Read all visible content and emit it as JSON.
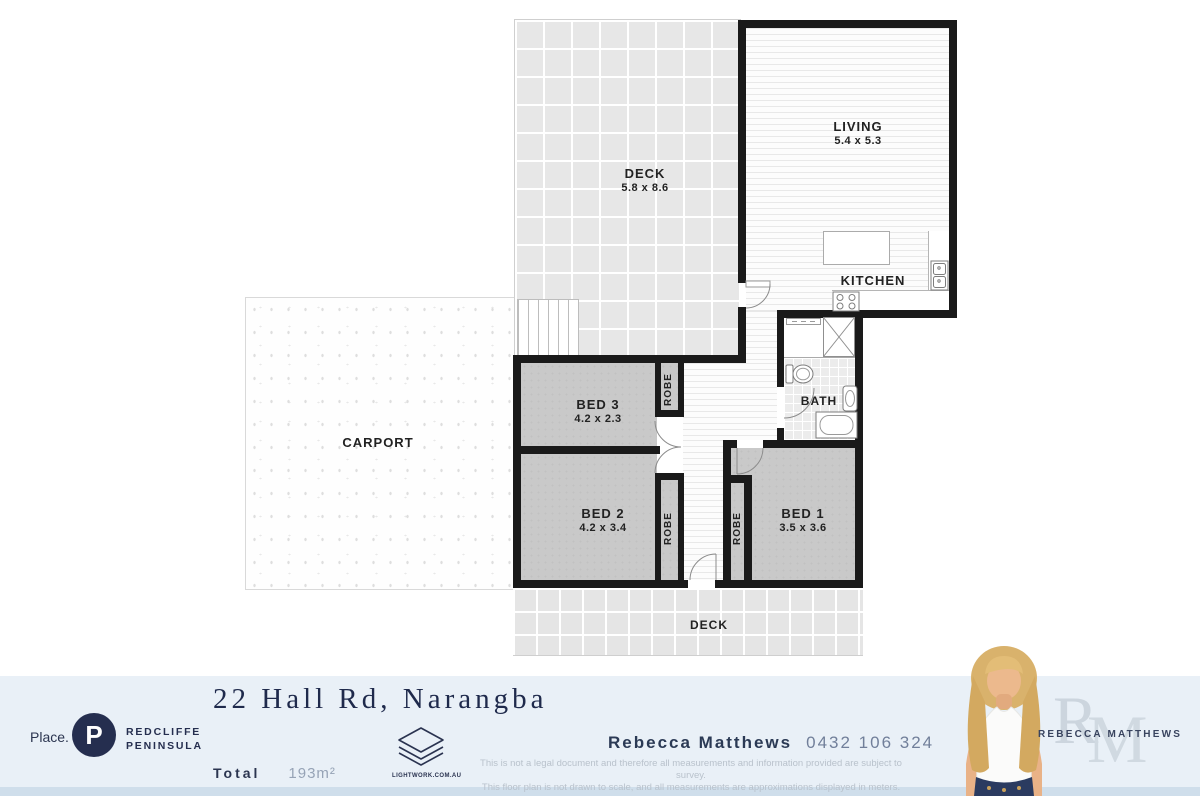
{
  "plan": {
    "rooms": {
      "deck_top": {
        "label": "DECK",
        "dims": "5.8 x 8.6"
      },
      "living": {
        "label": "LIVING",
        "dims": "5.4 x 5.3"
      },
      "kitchen": {
        "label": "KITCHEN"
      },
      "carport": {
        "label": "CARPORT"
      },
      "bed3": {
        "label": "BED 3",
        "dims": "4.2 x 2.3"
      },
      "bed2": {
        "label": "BED 2",
        "dims": "4.2 x 3.4"
      },
      "bed1": {
        "label": "BED 1",
        "dims": "3.5 x 3.6"
      },
      "bath": {
        "label": "BATH"
      },
      "deck_bottom": {
        "label": "DECK"
      },
      "robe": "ROBE"
    }
  },
  "footer": {
    "place_label": "Place.",
    "place_logo_letter": "P",
    "brand_line1": "REDCLIFFE",
    "brand_line2": "PENINSULA",
    "title": "22 Hall Rd, Narangba",
    "total_label": "Total",
    "total_value": "193m²",
    "lightwork_label": "LIGHTWORK.COM.AU",
    "agent_name": "Rebecca Matthews",
    "agent_phone": "0432 106 324",
    "disclaimer_line1": "This is not a legal document and therefore all measurements and information provided are subject to survey.",
    "disclaimer_line2": "This floor plan is not drawn to scale, and all measurements are approximations displayed in meters.",
    "agent_card_name": "REBECCA MATTHEWS",
    "monogram_r": "R",
    "monogram_m": "M"
  },
  "colors": {
    "wall": "#1a1a1a",
    "navy": "#252e4f",
    "footer_bg": "#e9f0f7",
    "footer_strip": "#cfdeeb",
    "carpet": "#c9c9c9",
    "deck_tile": "#e7e7e7"
  }
}
